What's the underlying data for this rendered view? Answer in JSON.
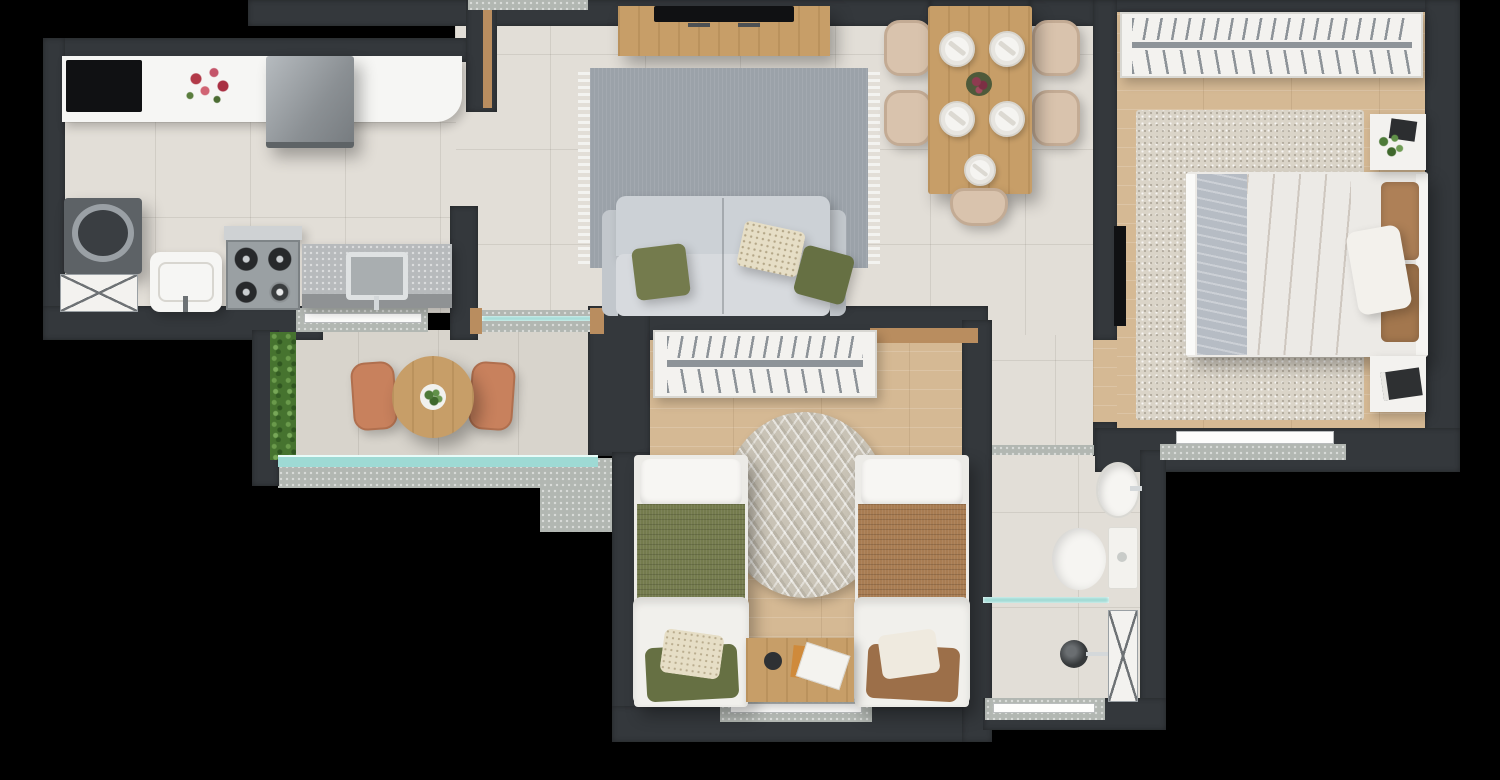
{
  "scene": {
    "kind": "apartment-floor-plan-render",
    "view": "top-down",
    "background": "#000000",
    "visible_text": "none"
  },
  "palette": {
    "wall": "#34383c",
    "wallDark": "#2a2e31",
    "tile": "#e2ded7",
    "balconyTile": "#d8d4cc",
    "wood": "#d5b994",
    "woodDoor": "#b98d5f",
    "woodFurniture": "#c79e68",
    "concrete": "#b2b7b2",
    "counter": "#f6f6f4",
    "granite": "#b7babc",
    "graniteEdge": "#8f9294",
    "black": "#101113",
    "appliance": "#8f9498",
    "washer": "#5d6266",
    "white": "#f3f2ef",
    "rugGray": "#9ba2a9",
    "rugRound": "#c9c3b6",
    "rugBedroom": "#dad4c8",
    "sofa": "#ccd1d6",
    "sofaSeat": "#d7dade",
    "olive": "#747b4d",
    "oliveDark": "#667043",
    "cream": "#e6dec6",
    "brown": "#ae8057",
    "brownBlanket": "#a87c52",
    "throw": "#b6bcc4",
    "beige": "#d9c3ad",
    "terracotta": "#c8815d",
    "hedge": "#46732f",
    "teal": "#9edad4",
    "chrome": "#d4d8da",
    "shelfBar": "#8d9398"
  },
  "rooms": [
    {
      "id": "kitchen-laundry",
      "items": [
        "white-counter",
        "cooktop",
        "flower-vase",
        "refrigerator",
        "washing-machine",
        "laundry-cabinet",
        "laundry-tub",
        "gas-stove",
        "granite-counter",
        "kitchen-sink",
        "pass-through-window"
      ]
    },
    {
      "id": "living-room",
      "items": [
        "tv-console",
        "tv",
        "gray-area-rug",
        "two-seat-sofa",
        "olive-pillows",
        "patterned-pillow"
      ]
    },
    {
      "id": "dining-area",
      "items": [
        "wood-dining-table",
        "five-place-settings",
        "flower-centerpiece",
        "five-beige-chairs"
      ]
    },
    {
      "id": "balcony",
      "items": [
        "hedge-planter",
        "round-wood-table",
        "plant-centerpiece",
        "two-terracotta-chairs",
        "glass-railing"
      ]
    },
    {
      "id": "bedroom-double",
      "items": [
        "wardrobe-with-hangers",
        "speckled-rug",
        "double-bed-brown-duvet",
        "gray-throw",
        "white-pillow",
        "nightstand-plant",
        "nightstand-books",
        "wall-tv",
        "window"
      ]
    },
    {
      "id": "bedroom-twin",
      "items": [
        "bookshelf",
        "round-chevron-rug",
        "single-bed-olive",
        "single-bed-brown",
        "wood-side-table",
        "magazines",
        "window"
      ]
    },
    {
      "id": "bathroom",
      "items": [
        "oval-sink",
        "toilet",
        "glass-shower-screen",
        "shower-head",
        "service-shaft",
        "window"
      ]
    },
    {
      "id": "hallway",
      "items": [
        "door-threshold"
      ]
    }
  ]
}
